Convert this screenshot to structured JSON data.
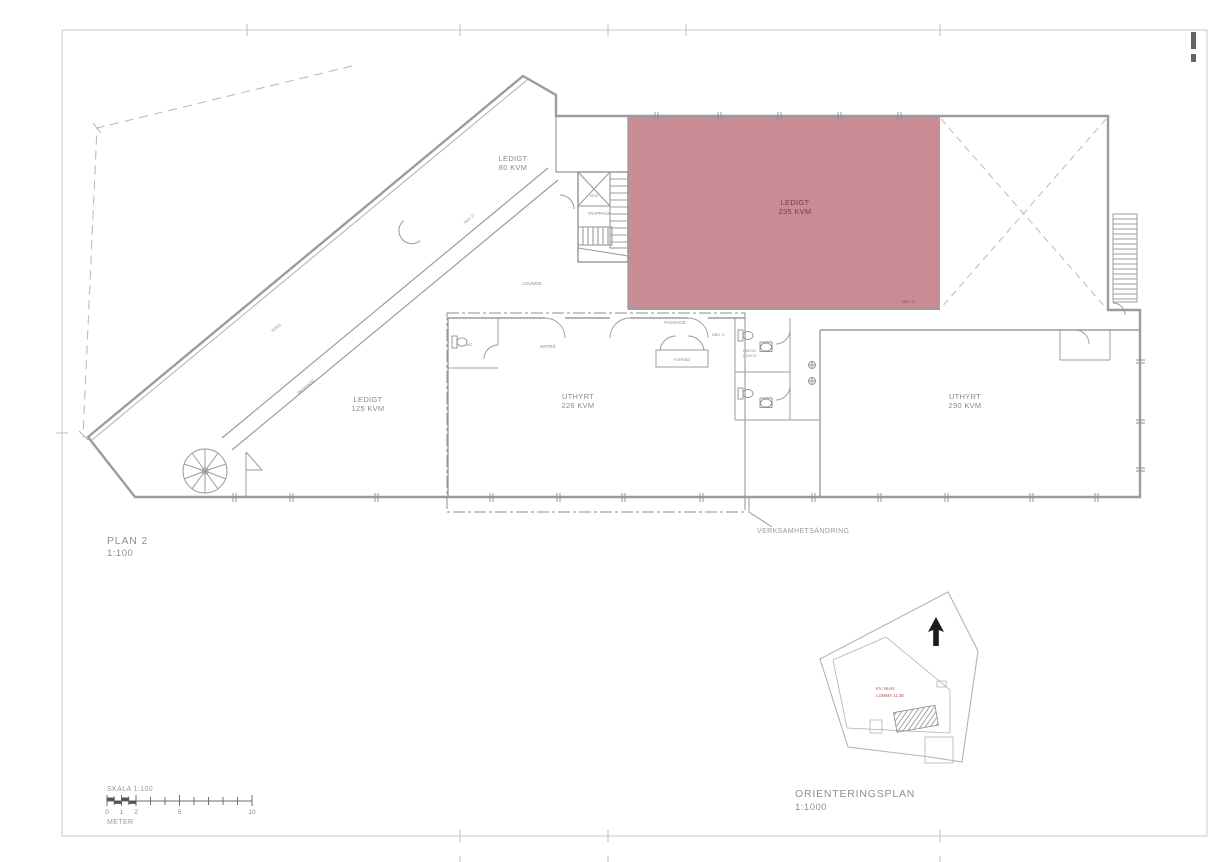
{
  "page": {
    "background": "#ffffff",
    "frame_color": "#c9c9c9"
  },
  "plan": {
    "title": "PLAN 2",
    "scale": "1:100",
    "highlight_color": "#c98b94",
    "rooms": {
      "ledigt80": {
        "status": "LEDIGT",
        "area": "80 KVM"
      },
      "ledigt235": {
        "status": "LEDIGT",
        "area": "235 KVM"
      },
      "ledigt125": {
        "status": "LEDIGT",
        "area": "125 KVM"
      },
      "uthyrt226": {
        "status": "UTHYRT",
        "area": "226 KVM"
      },
      "uthyrt290": {
        "status": "UTHYRT",
        "area": "290 KVM"
      }
    },
    "labels": {
      "trapphus": "TRAPPHUS",
      "hiss": "HISS",
      "lounge": "LOUNGE",
      "passage_diagonal": "PASSAGE",
      "passage_horizontal": "PASSAGE",
      "entre": "ENTRÉ",
      "forrad": "FÖRRÅD",
      "wc": "WC",
      "rwc": "RWC/D",
      "dusch": "DUSCH",
      "torg": "TORG",
      "ned17_corridor": "NED 17",
      "ned17_passage": "NED 17",
      "ned17_red": "NED 17",
      "annotation": "VERKSAMHETSÄNDRING"
    }
  },
  "scalebar": {
    "title": "SKALA 1:100",
    "unit": "METER",
    "ticks": [
      "0",
      "1",
      "2",
      "5",
      "10"
    ]
  },
  "orientation": {
    "title": "ORIENTERINGSPLAN",
    "scale": "1:1000",
    "site_label_line1": "KV. NIAN",
    "site_label_line2": "LOMMA 11:38"
  }
}
